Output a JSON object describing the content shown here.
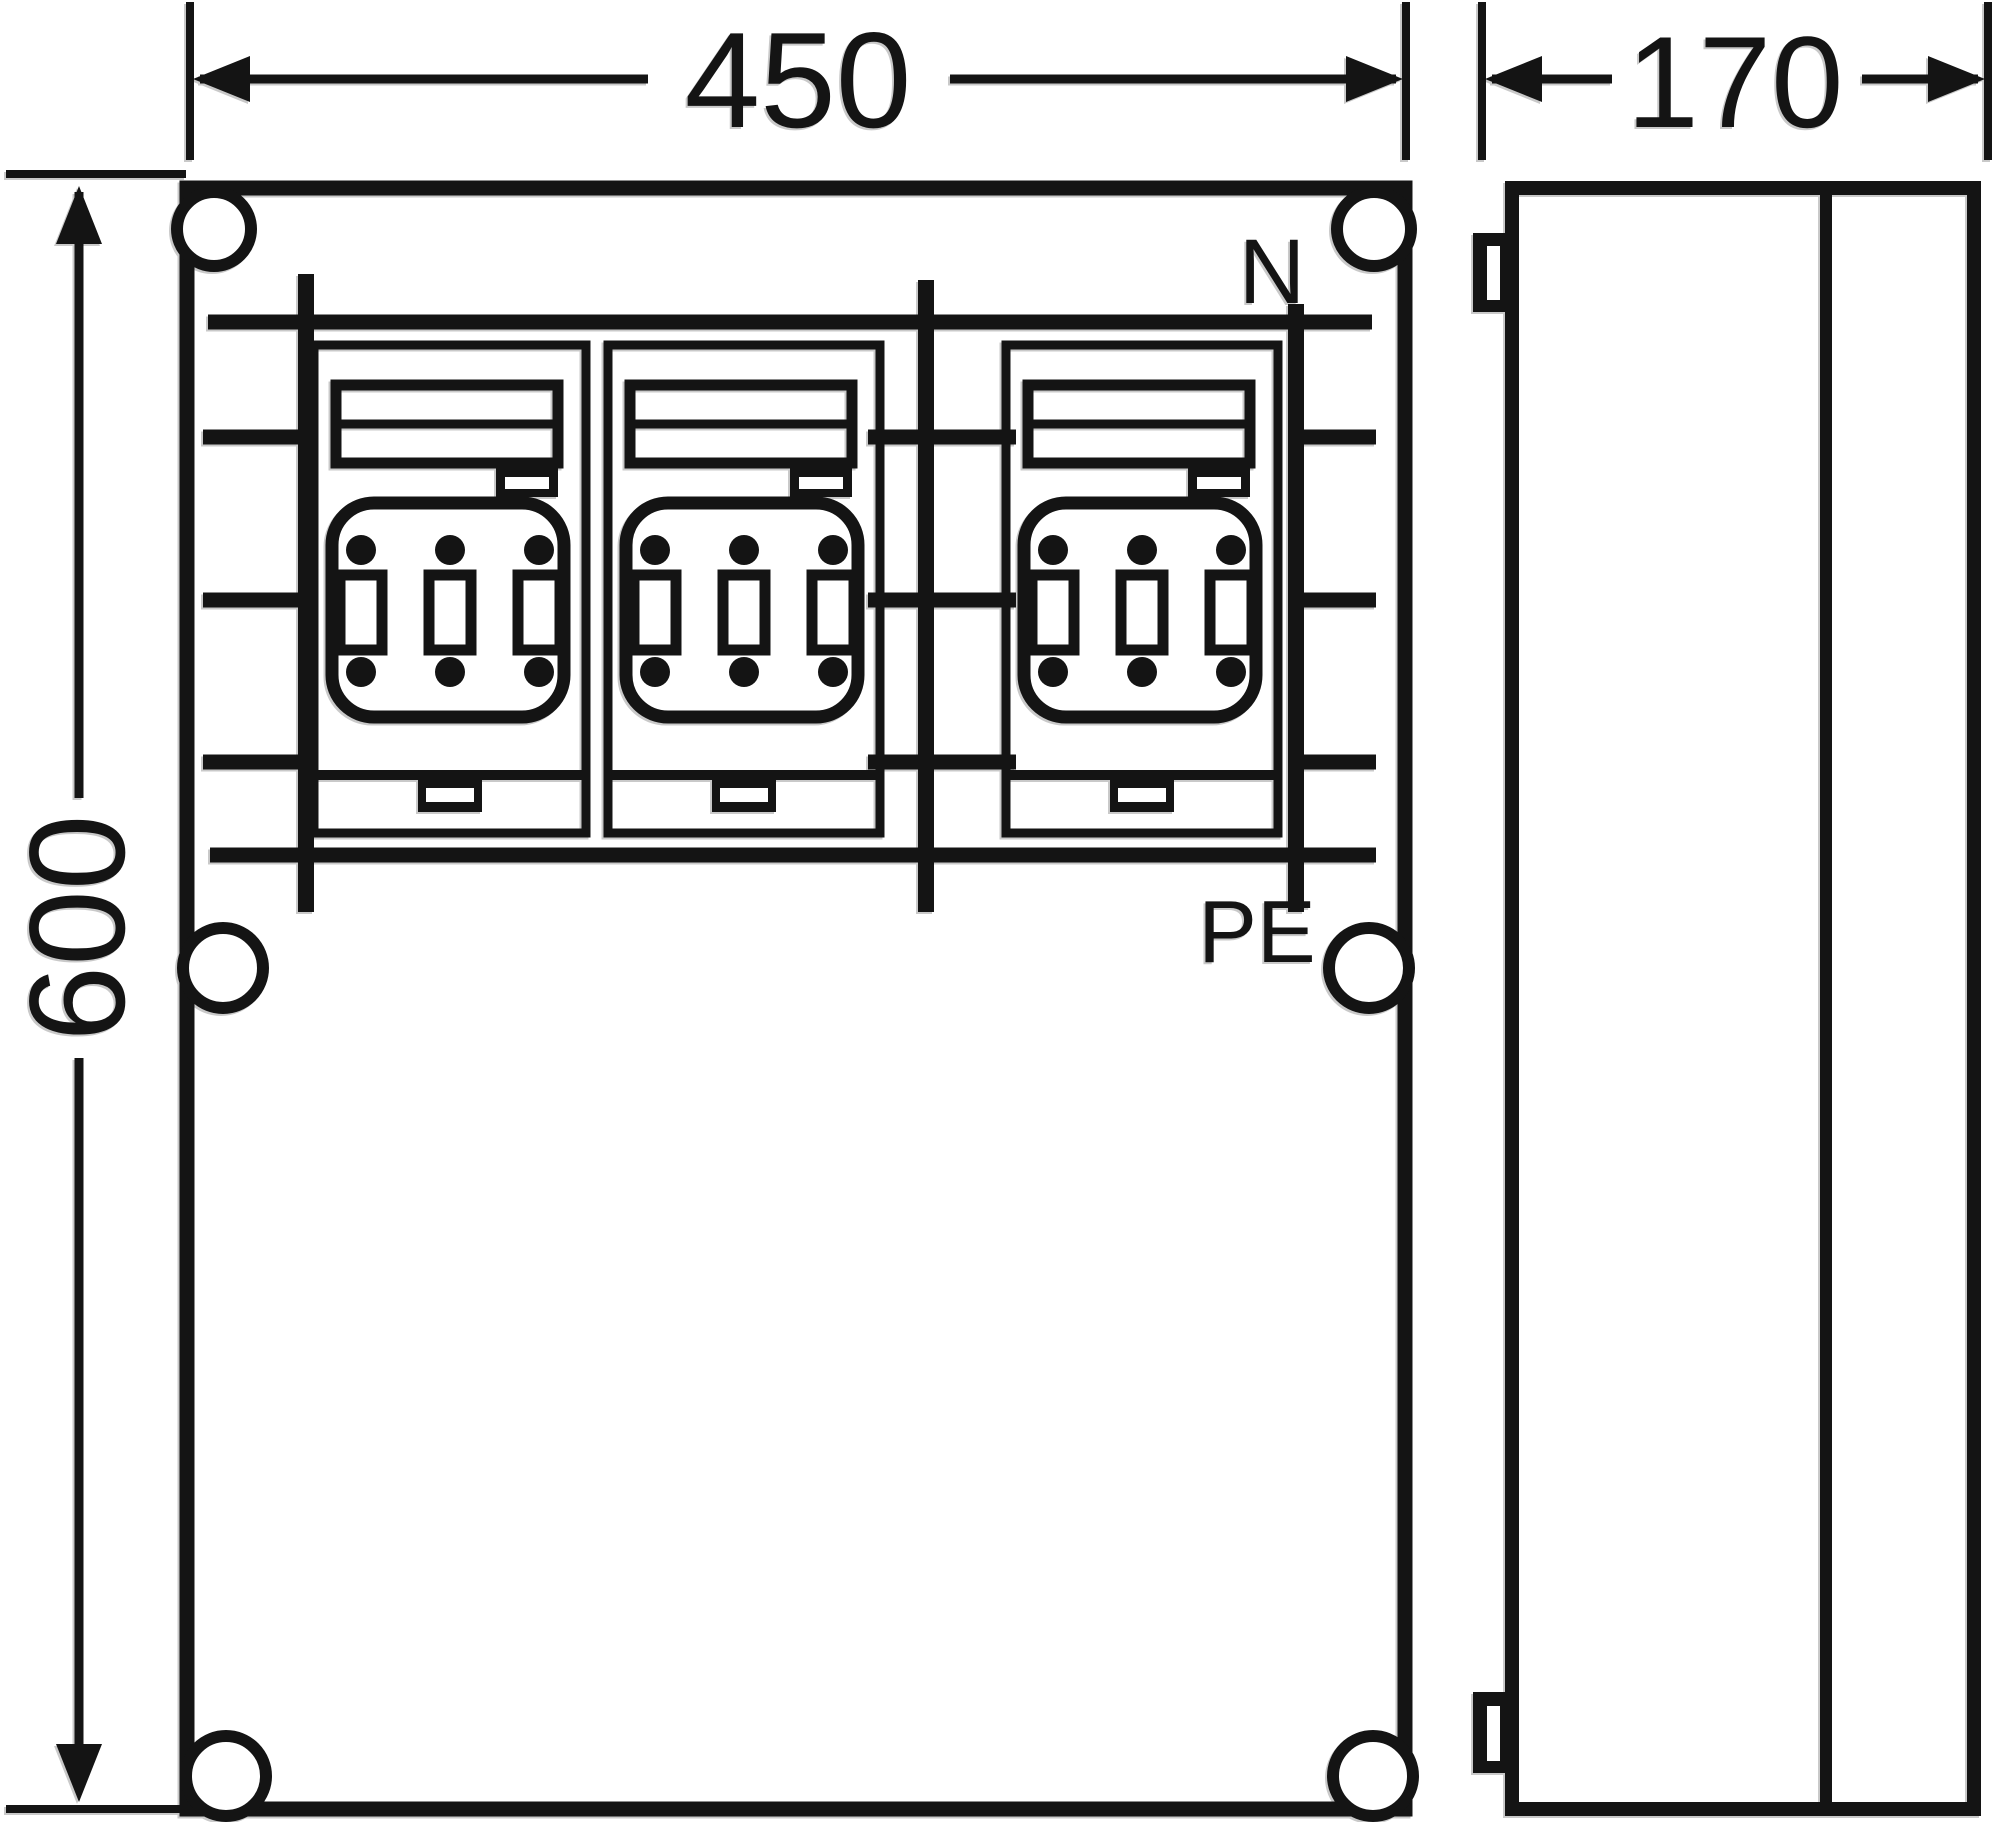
{
  "figure": {
    "type": "technical-enclosure-drawing",
    "views": [
      "front",
      "side"
    ],
    "module_count": 3
  },
  "dimensions": {
    "width_mm": "450",
    "depth_mm": "170",
    "height_mm": "600"
  },
  "terminals": {
    "neutral": "N",
    "protective_earth": "PE"
  },
  "colors": {
    "ink": "#141414",
    "paper": "#ffffff",
    "shadow": "#c9c9c9"
  }
}
